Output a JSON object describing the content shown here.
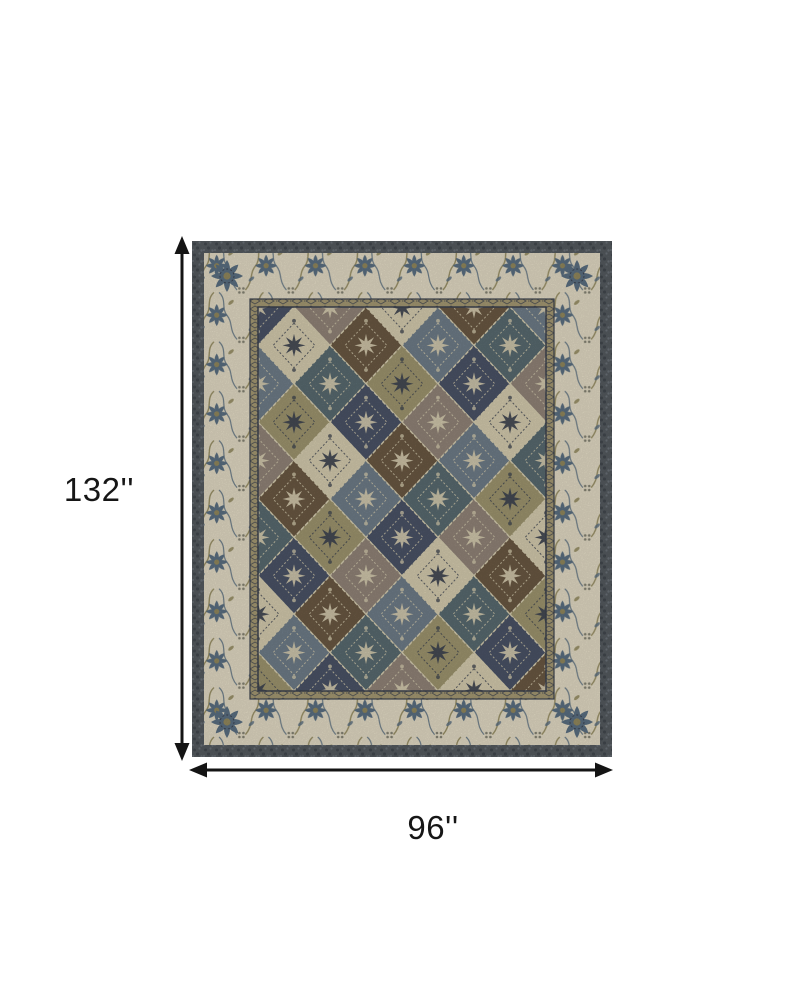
{
  "dimensions": {
    "height_label": "132''",
    "width_label": "96''"
  },
  "colors": {
    "page_background": "#ffffff",
    "dimension_line": "#141414",
    "label_text": "#161616",
    "rug_outer_trim": "#585e63",
    "rug_trim_dark": "#454b51",
    "rug_trim_light": "#6f767d",
    "rug_border_ivory": "#eae2cb",
    "rug_motif_blue": "#5e7386",
    "rug_motif_olive": "#978d60",
    "rug_motif_gray": "#8a8878",
    "rug_guard_tan": "#ab9e77",
    "rug_field_base": "#6b6253",
    "motif_cream": "#ddd4b6",
    "motif_dark": "#3f4552"
  },
  "rug": {
    "patch_palette": [
      "#4d566a",
      "#6e5b45",
      "#a39a72",
      "#dcd2b4",
      "#5c6e74",
      "#96887c",
      "#72808d"
    ]
  }
}
